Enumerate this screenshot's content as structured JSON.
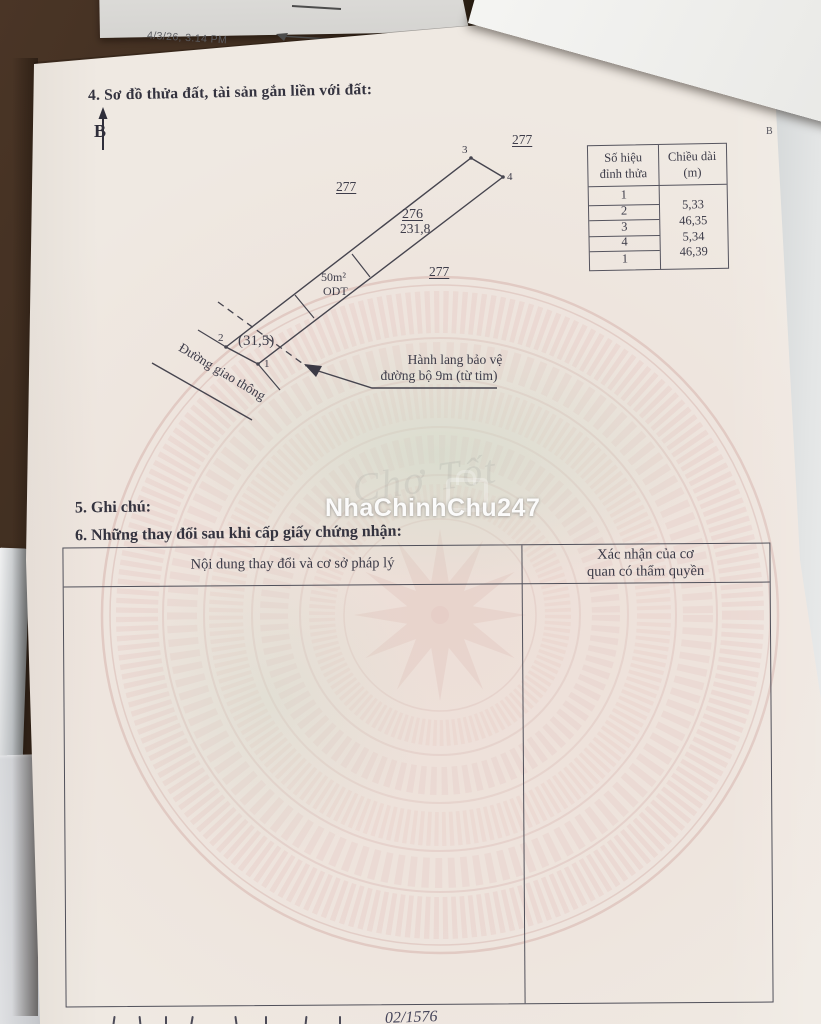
{
  "colors": {
    "desk": "#3a2a1d",
    "page": "#efe9e2",
    "ink": "#3b3946",
    "emblem_pink": "#e6cdc7",
    "emblem_green": "#d9e4d6",
    "watermark_white": "#ffffff"
  },
  "photo": {
    "timestamp": "4/3/26, 3:14 PM",
    "corner_letter": "B"
  },
  "watermark": {
    "text": "NhaChinhChu247",
    "brand": "Chợ Tốt"
  },
  "doc": {
    "heading4": "4. Sơ đồ thửa đất, tài sản gắn liền với đất:",
    "north_letter": "B",
    "diagram": {
      "adj277_top": "277",
      "adj277_left": "277",
      "adj277_mid": "277",
      "parcel_no": "276",
      "parcel_area": "231,8",
      "sub_area": "50m²",
      "sub_type": "ODT",
      "corridor_area": "(31,5)",
      "v1": "1",
      "v2": "2",
      "v3": "3",
      "v4": "4",
      "road": "Đường giao thông",
      "corridor_line1": "Hành lang bảo vệ",
      "corridor_line2": "đường bộ 9m (từ tim)"
    },
    "edge_table": {
      "h1a": "Số hiệu",
      "h1b": "đỉnh thửa",
      "h2a": "Chiều dài",
      "h2b": "(m)",
      "rows": [
        "1",
        "2",
        "3",
        "4",
        "1"
      ],
      "lengths": [
        "5,33",
        "46,35",
        "5,34",
        "46,39"
      ]
    },
    "heading5": "5. Ghi chú:",
    "heading6": "6. Những thay đổi sau khi cấp giấy chứng nhận:",
    "changes_table": {
      "col1_header": "Nội dung thay đổi và cơ sở pháp lý",
      "col2_header_line1": "Xác nhận của cơ",
      "col2_header_line2": "quan có thẩm quyền"
    },
    "footer_fragment": "02/1576"
  }
}
